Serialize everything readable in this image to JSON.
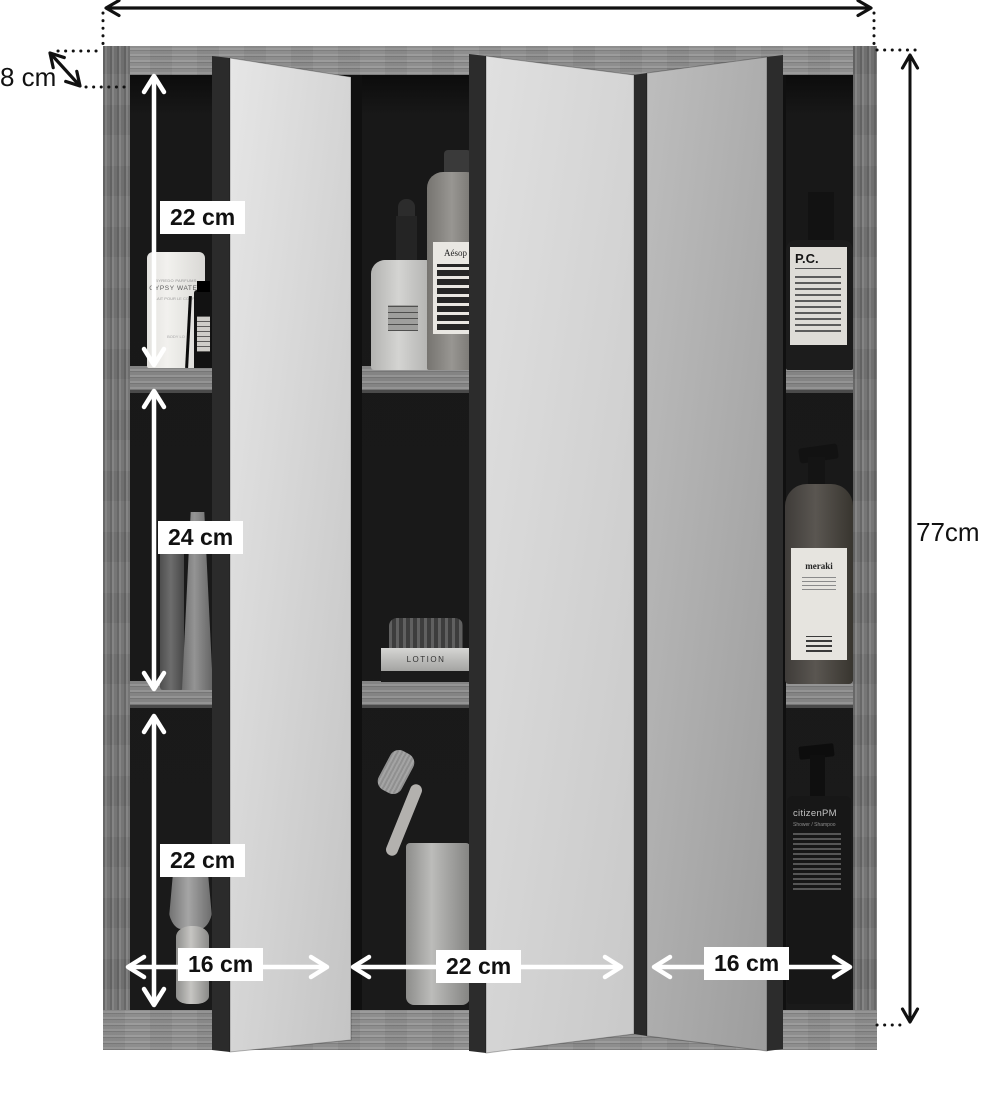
{
  "dimensions": {
    "depth": {
      "label": "8 cm"
    },
    "height": {
      "label": "77cm"
    },
    "left_sections": [
      {
        "label": "22 cm"
      },
      {
        "label": "24 cm"
      },
      {
        "label": "22 cm"
      }
    ],
    "bottom_sections": [
      {
        "label": "16 cm"
      },
      {
        "label": "22 cm"
      },
      {
        "label": "16 cm"
      }
    ]
  },
  "products": {
    "gypsy_water": {
      "brand": "BYREDO PARFUMS",
      "name": "GYPSY WATER",
      "subtitle": "LAIT POUR LE CORPS",
      "footer": "BODY LO"
    },
    "aesop": {
      "name": "Aésop"
    },
    "lotion_jar": {
      "name": "LOTION"
    },
    "pc_bottle": {
      "name": "P.C."
    },
    "meraki": {
      "name": "meraki"
    },
    "citizen": {
      "name": "citizenPM",
      "subtitle": "Shower / Shampoo"
    }
  },
  "colors": {
    "wood": "#7c7c7c",
    "interior": "#171717",
    "mirror": "#d6d6d6",
    "label_background": "#ffffff",
    "label_text": "#111111",
    "arrow_white": "#ffffff",
    "arrow_black": "#111111"
  }
}
